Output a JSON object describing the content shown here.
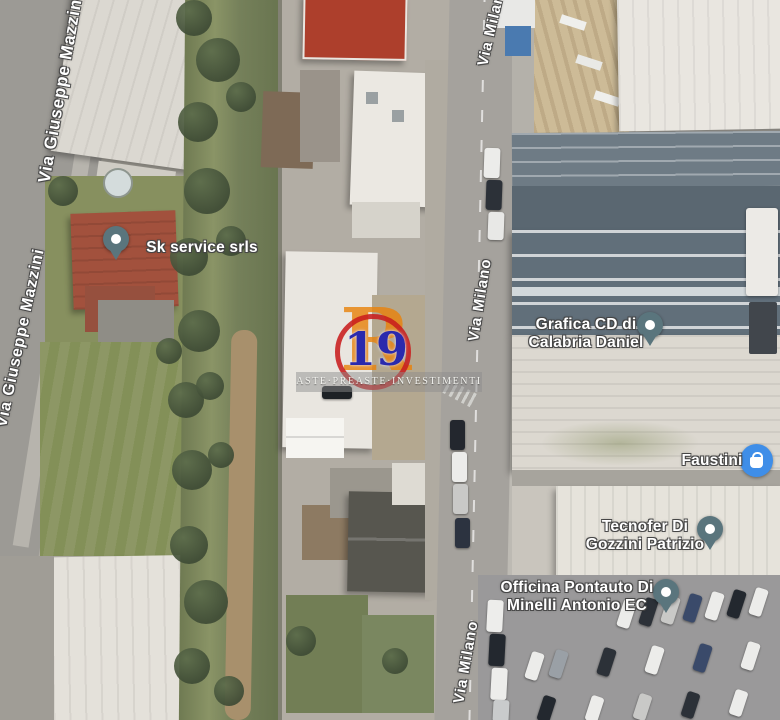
{
  "map": {
    "view": "satellite",
    "streets": {
      "mazzini_top": "Via Giuseppe Mazzini",
      "mazzini_left": "Via Giuseppe Mazzini",
      "milano_top": "Via Milano",
      "milano_mid": "Via Milano",
      "milano_bottom": "Via Milano"
    },
    "places": {
      "sk_service": {
        "label": "Sk service srls",
        "icon": "map-pin"
      },
      "grafica": {
        "line1": "Grafica CD di",
        "line2": "Calabria Daniel",
        "icon": "map-pin"
      },
      "faustini": {
        "label": "Faustini",
        "icon": "shopping-bag"
      },
      "tecnofer": {
        "line1": "Tecnofer Di",
        "line2": "Gozzini Patrizio",
        "icon": "map-pin"
      },
      "officina": {
        "line1": "Officina Pontauto Di",
        "line2": "Minelli Antonio EC",
        "icon": "map-pin"
      }
    },
    "watermark": {
      "lot_number": "19",
      "logo_letter": "R",
      "banner_text": "ASTE·PREASTE·INVESTIMENTI",
      "ring_color": "#c81e1e",
      "letter_color": "#e8820c",
      "number_color": "#2a2aad"
    }
  }
}
